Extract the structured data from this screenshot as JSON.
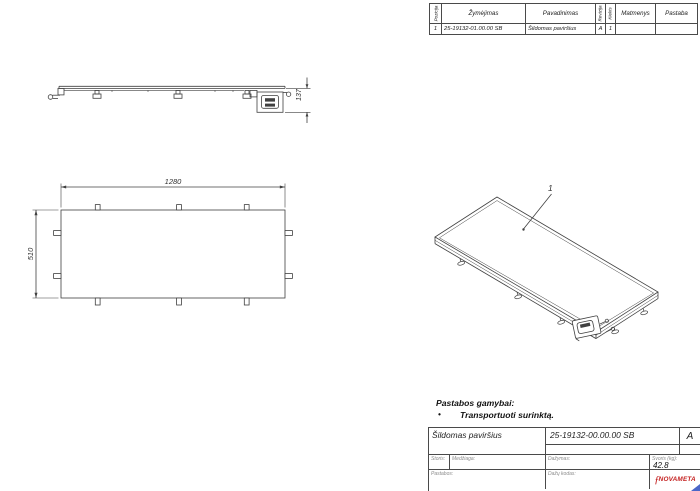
{
  "colors": {
    "line": "#404040",
    "logo_red": "#c4201f",
    "corner_blue": "#4a66c8"
  },
  "parts_table": {
    "headers": {
      "pozicija": "Pozicija",
      "zymejimas": "Žymėjimas",
      "pavadinimas": "Pavadinimas",
      "revizija": "Revizija",
      "kiekis": "Kiekis",
      "matmenys": "Matmenys",
      "pastaba": "Pastaba"
    },
    "row": {
      "pozicija": "1",
      "zymejimas": "25-19132-01.00.00 SB",
      "pavadinimas": "Šildomas paviršius",
      "revizija": "A",
      "kiekis": "1",
      "matmenys": "",
      "pastaba": ""
    }
  },
  "dimensions": {
    "plan_width": "1280",
    "plan_depth": "510",
    "side_height": "137",
    "iso_item_number": "1"
  },
  "notes": {
    "title": "Pastabos gamybai:",
    "bullet": "•",
    "item": "Transportuoti surinktą."
  },
  "title_block": {
    "part_name": "Šildomas paviršius",
    "drawing_number": "25-19132-00.00.00 SB",
    "revision": "A",
    "storis_label": "Storis:",
    "medziaga_label": "Medžiaga:",
    "dazymas_label": "Dažymas:",
    "svoris_label": "Svoris (kg):",
    "svoris_value": "42.8",
    "pastabos_label": "Pastabos:",
    "dazu_kodas_label": "Dažų kodas:",
    "logo": {
      "flourish": "ƒ",
      "text": "NOVAMETA"
    }
  }
}
